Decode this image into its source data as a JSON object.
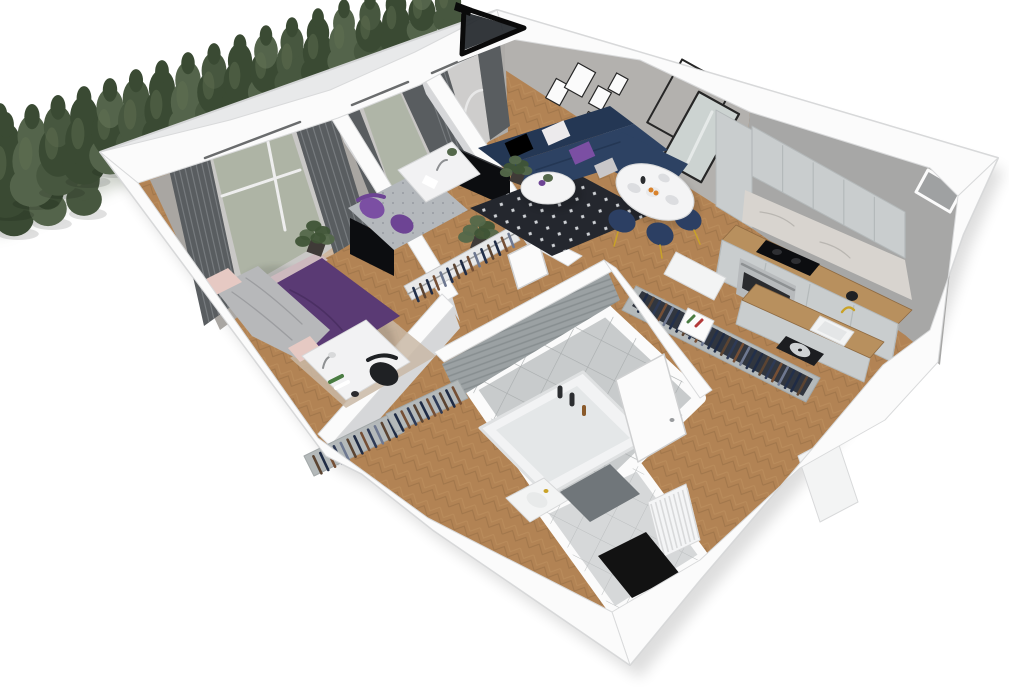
{
  "palette": {
    "bg": "#ffffff",
    "wall_top": "#fbfbfb",
    "wall_edge": "#d9dadb",
    "wall_outer": "#e8e9ea",
    "wall_face": "#d6d7d9",
    "wall_warm": "#a9a6a2",
    "wall_warm2": "#a4a19d",
    "wall_warm3": "#aeaca9",
    "wall_ne1": "#b3b1ae",
    "wall_ne2": "#a7a7a6",
    "floor_wood": "#b28354",
    "wood_dark": "#8f6a41",
    "wood_light": "#c99e6b",
    "tile_base": "#c8cbcc",
    "tile_line": "#a9adae",
    "tile_entry": "#d6d8d9",
    "tile_entry_line": "#bcbfc0",
    "bath_wall": "#9ba1a3",
    "bath_wall_line": "#878e90",
    "window_green": "#6d7b5a",
    "curtain": "#595d60",
    "curtain_hi": "#84888c",
    "sheer": "#e9eaea",
    "tree1": "#47573f",
    "tree2": "#3a4a33",
    "tree3": "#54644b",
    "tree_hi": "#627153",
    "sofa": "#2d4263",
    "sofa_dark": "#243754",
    "bed_purple": "#5a3a74",
    "bed_purple_dark": "#4b2f63",
    "accent_purple": "#7b4fa3",
    "accent_purple2": "#6d4494",
    "blanket": "#b7b8ba",
    "headboard": "#cdb9be",
    "pink": "#e6c9c3",
    "rug_dark": "#24272e",
    "rug_dot": "#cfd2d6",
    "rug_office": "#b4b8bc",
    "rug_bed": "#c9b8a6",
    "chair_black": "#1f2124",
    "navy_chair": "#2c3f63",
    "gold": "#c9a227",
    "white_obj": "#f3f4f4",
    "obj_edge": "#d8d9da",
    "counter": "#b8905e",
    "cabinet": "#c9cdce",
    "cabinet_dark": "#b4b9ba",
    "marble": "#d8d4cf",
    "black": "#0c0d10",
    "steel": "#b7babc",
    "oven_glass": "#2a2b2e",
    "mirror": "#ccd3d1",
    "frame": "#262626",
    "clothes1": "#1f2b44",
    "clothes2": "#2e3a55",
    "clothes3": "#5b4432",
    "clothes4": "#6e7890",
    "clothes5": "#23304a",
    "clothes6": "#754f35",
    "mat": "#70767a",
    "doormat": "#121212",
    "green_plant": "#3f5436",
    "green_plant2": "#54684a",
    "pot": "#3f3a37",
    "shadow": "#000000",
    "book_red": "#b33939",
    "book_green": "#4a7c42"
  },
  "scene": {
    "view": "3d-cutaway-floor-plan",
    "rooms": [
      {
        "id": "bedroom",
        "label": "bedroom"
      },
      {
        "id": "study",
        "label": "study"
      },
      {
        "id": "living-room",
        "label": "living room"
      },
      {
        "id": "dining-area",
        "label": "dining area"
      },
      {
        "id": "kitchen",
        "label": "kitchen"
      },
      {
        "id": "bathroom",
        "label": "bathroom"
      },
      {
        "id": "hallway",
        "label": "hallway"
      },
      {
        "id": "entry",
        "label": "entry"
      }
    ],
    "exterior": [
      {
        "id": "garden-hedge",
        "label": "hedge of trees"
      },
      {
        "id": "balcony-window",
        "label": "balcony window frame"
      }
    ],
    "furniture": [
      {
        "id": "double-bed",
        "room": "bedroom"
      },
      {
        "id": "bedroom-desk",
        "room": "bedroom"
      },
      {
        "id": "nightstand",
        "room": "bedroom"
      },
      {
        "id": "tv-bedroom",
        "room": "bedroom"
      },
      {
        "id": "study-desk",
        "room": "study"
      },
      {
        "id": "purple-chairs",
        "room": "study"
      },
      {
        "id": "clothes-rack",
        "room": "study"
      },
      {
        "id": "tv-living",
        "room": "living-room"
      },
      {
        "id": "corner-sofa",
        "room": "living-room"
      },
      {
        "id": "coffee-table",
        "room": "living-room"
      },
      {
        "id": "wall-art",
        "room": "living-room"
      },
      {
        "id": "mirror",
        "room": "living-room"
      },
      {
        "id": "dining-table",
        "room": "dining-area"
      },
      {
        "id": "dining-chairs",
        "room": "dining-area"
      },
      {
        "id": "kitchen-cabinets",
        "room": "kitchen"
      },
      {
        "id": "cooktop",
        "room": "kitchen"
      },
      {
        "id": "oven",
        "room": "kitchen"
      },
      {
        "id": "kitchen-sink",
        "room": "kitchen"
      },
      {
        "id": "turntable",
        "room": "kitchen"
      },
      {
        "id": "wardrobe-run",
        "room": "hallway"
      },
      {
        "id": "hall-wardrobes",
        "room": "hallway"
      },
      {
        "id": "bathtub",
        "room": "bathroom"
      },
      {
        "id": "washbasin",
        "room": "bathroom"
      },
      {
        "id": "bath-mat",
        "room": "bathroom"
      },
      {
        "id": "radiator",
        "room": "entry"
      },
      {
        "id": "doormat",
        "room": "entry"
      }
    ]
  }
}
